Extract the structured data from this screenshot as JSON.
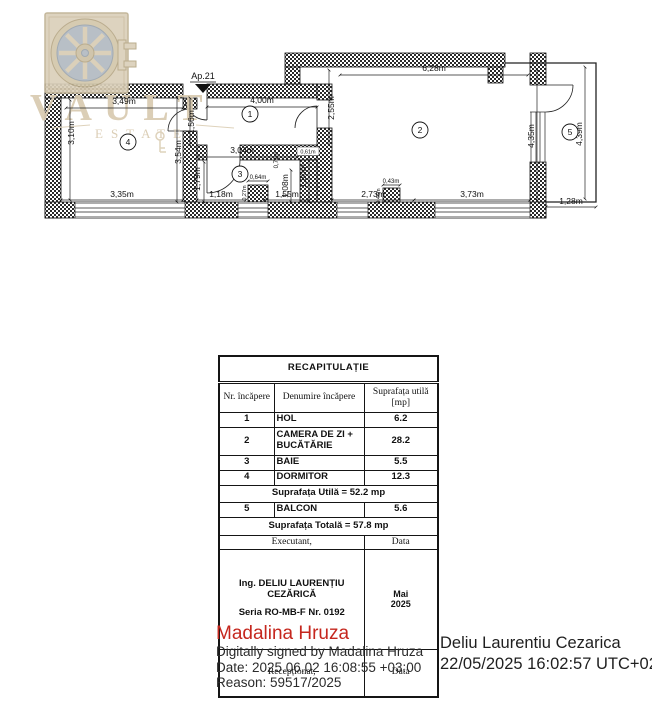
{
  "watermark": {
    "brand": "VAULT",
    "sub": "ESTATE",
    "color": "#d8cab0"
  },
  "plan": {
    "entrance_label": "Ap.21",
    "rooms": {
      "r1": "1",
      "r2": "2",
      "r3": "3",
      "r4": "4",
      "r5": "5"
    },
    "dims": {
      "d349": "3,49m",
      "d400": "4,00m",
      "d628": "6,28m",
      "d335": "3,35m",
      "d118": "1,18m",
      "d155": "1,55m",
      "d273": "2,73m",
      "d373": "3,73m",
      "d128": "1,28m",
      "d310": "3,10m",
      "d156": "1,56m",
      "d354": "3,54m",
      "d179": "1,79m",
      "d255": "2,55m",
      "d304": "3,04m",
      "d064": "0,64m",
      "d027": "0,27m",
      "d108": "1,08m",
      "d071": "0,71m",
      "d061": "0,61m",
      "d180": "1,80m",
      "d043": "0,43m",
      "d046": "0,46m",
      "d435": "4,35m",
      "d439": "4,39m"
    }
  },
  "table": {
    "title": "RECAPITULAȚIE",
    "col_nr": "Nr. încăpere",
    "col_name": "Denumire încăpere",
    "col_area": "Suprafața utilă [mp]",
    "rows": [
      {
        "nr": "1",
        "name": "HOL",
        "area": "6.2"
      },
      {
        "nr": "2",
        "name": "CAMERA DE ZI + BUCĂTĂRIE",
        "area": "28.2"
      },
      {
        "nr": "3",
        "name": "BAIE",
        "area": "5.5"
      },
      {
        "nr": "4",
        "name": "DORMITOR",
        "area": "12.3"
      }
    ],
    "utila": "Suprafața Utilă = 52.2 mp",
    "balcon": {
      "nr": "5",
      "name": "BALCON",
      "area": "5.6"
    },
    "totala": "Suprafața Totală = 57.8 mp",
    "exec_label": "Executant,",
    "data_label": "Data",
    "exec_name": "Ing. DELIU LAURENȚIU CEZĂRICĂ",
    "exec_seria": "Seria RO-MB-F Nr. 0192",
    "exec_date": "Mai 2025",
    "recep_label": "Recepționat,",
    "recep_data": "Data"
  },
  "signature_left": {
    "name": "Madalina Hruza",
    "name_color": "#c5271e",
    "line1": "Digitally signed by Madalina Hruza",
    "line2": "Date: 2025.06.02 16:08:55 +03:00",
    "line3": "Reason: 59517/2025"
  },
  "signature_right": {
    "name": "Deliu Laurentiu Cezarica",
    "timestamp": "22/05/2025 16:02:57 UTC+02"
  }
}
